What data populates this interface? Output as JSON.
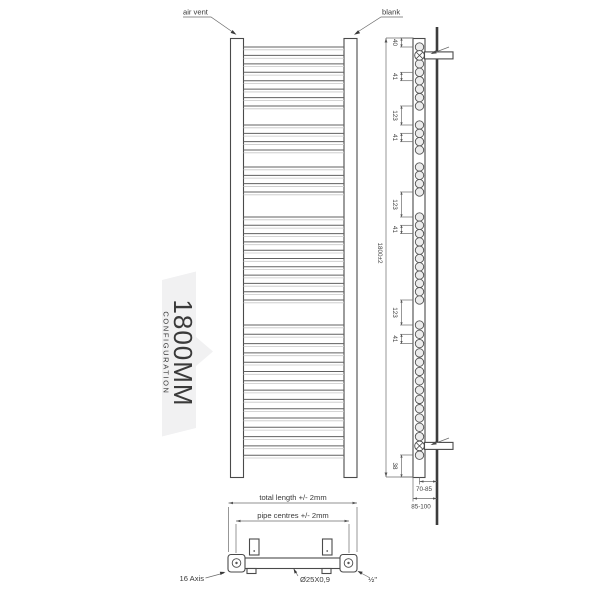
{
  "diagram": {
    "front": {
      "air_vent_label": "air vent",
      "blank_label": "blank"
    },
    "banner": {
      "title": "1800MM",
      "subtitle": "CONFIGURATION",
      "text_color": "#2f7e81",
      "bg_color": "#f1f1f2"
    },
    "side": {
      "overall_dim": "1800±2",
      "dims": [
        {
          "label": "40",
          "from": 38,
          "to": 47
        },
        {
          "label": "41",
          "from": 72.3,
          "to": 80.7
        },
        {
          "label": "123",
          "from": 106,
          "to": 125
        },
        {
          "label": "41",
          "from": 133.3,
          "to": 141.7
        },
        {
          "label": "123",
          "from": 192,
          "to": 217
        },
        {
          "label": "41",
          "from": 225.3,
          "to": 233.6
        },
        {
          "label": "123",
          "from": 300,
          "to": 325
        },
        {
          "label": "41",
          "from": 334.3,
          "to": 343.6
        },
        {
          "label": "38",
          "from": 455,
          "to": 477
        }
      ],
      "wall_offset_near": "70-85",
      "wall_offset_far": "85-100"
    },
    "bottom": {
      "total_length_label": "total length +/- 2mm",
      "pipe_centres_label": "pipe centres +/- 2mm",
      "axis_label": "16 Axis",
      "tube_spec_label": "Ø25X0,9",
      "connection_label": "½\""
    },
    "geometry": {
      "bar_groups": [
        {
          "start": 47,
          "count": 8,
          "pitch": 8.43
        },
        {
          "start": 125,
          "count": 4,
          "pitch": 8.33
        },
        {
          "start": 167,
          "count": 4,
          "pitch": 8.33
        },
        {
          "start": 217,
          "count": 11,
          "pitch": 8.3
        },
        {
          "start": 325,
          "count": 15,
          "pitch": 9.3
        }
      ],
      "bracket_ys": [
        55.4,
        445.9
      ],
      "bar_x1": 243.5,
      "bar_x2": 344,
      "side_circle_x": 419.5,
      "dim_ext_x1": 400,
      "dim_ext_x2": 413.5,
      "dim_line_x": 401.5,
      "dim_label_x": 393
    }
  }
}
